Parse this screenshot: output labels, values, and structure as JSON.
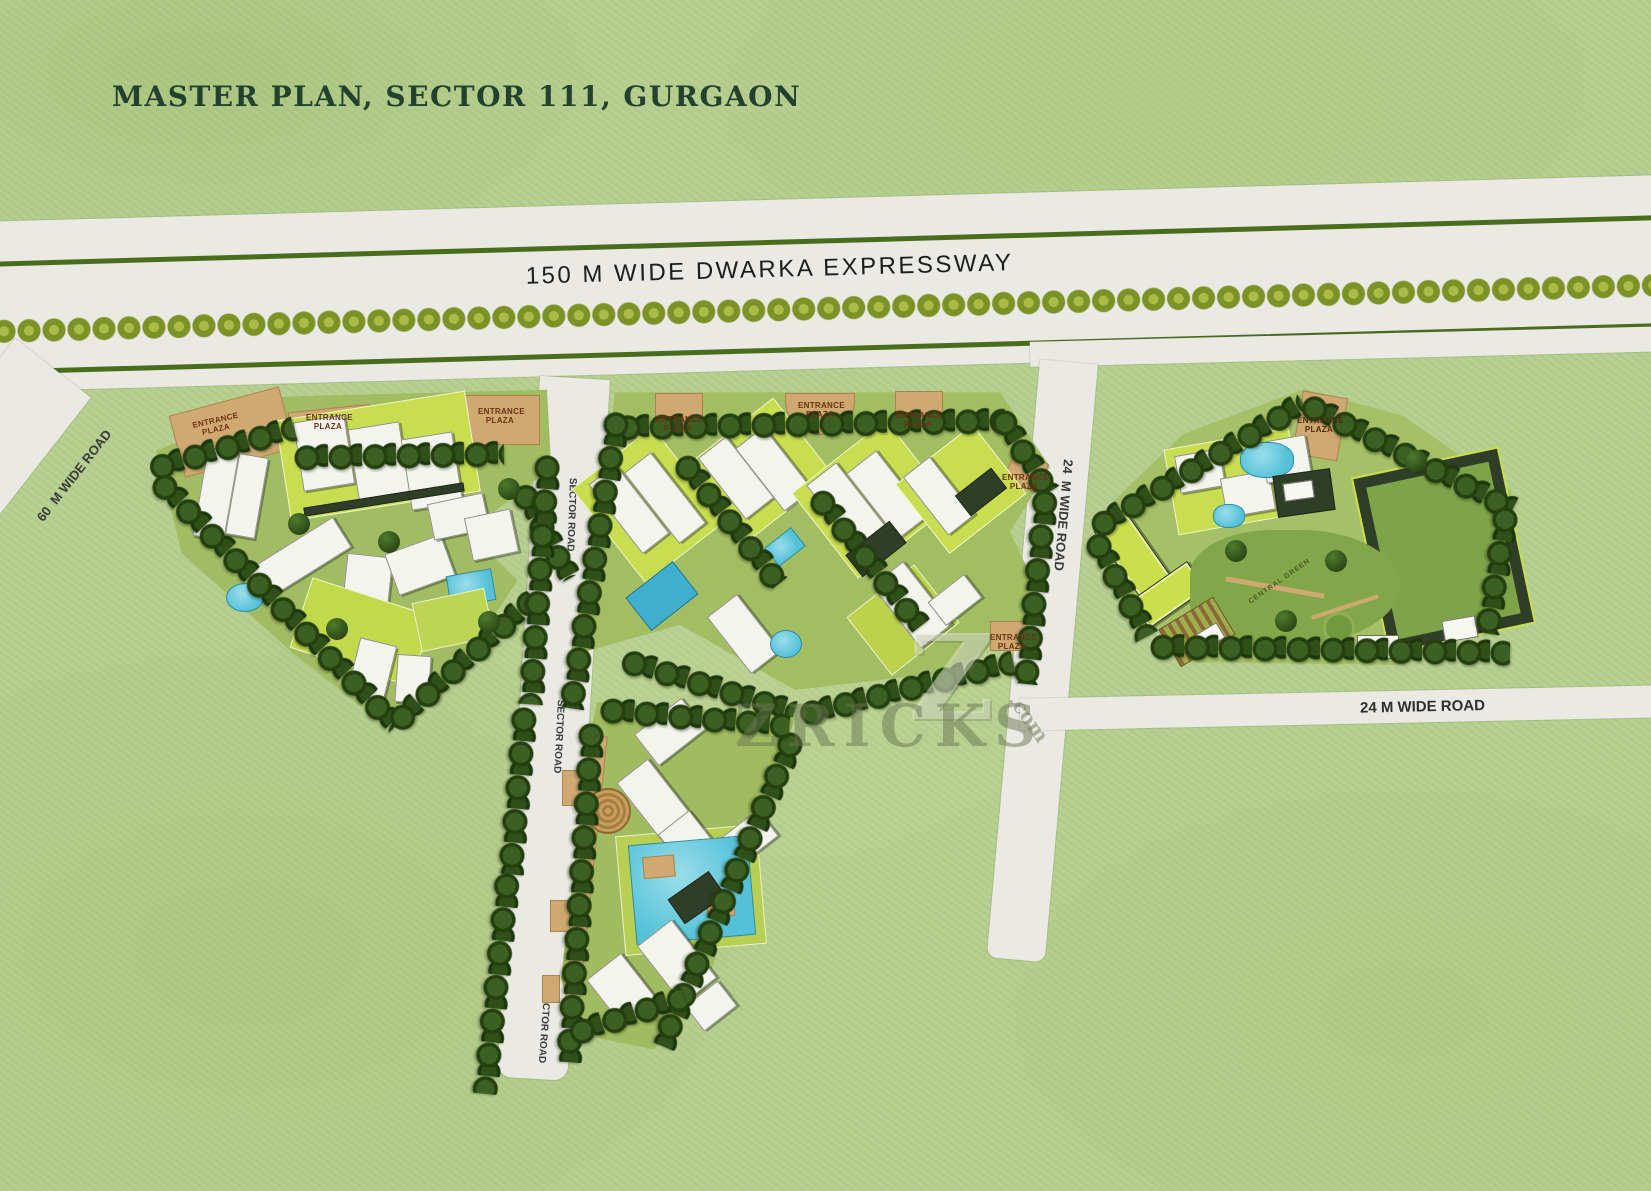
{
  "title": "MASTER PLAN, SECTOR 111, GURGAON",
  "roads": {
    "expressway_label": "150 M WIDE DWARKA EXPRESSWAY",
    "road_60m_label": "60  M WIDE ROAD",
    "sector_road_label": "SECTOR ROAD",
    "road_24m_vertical_label": "24  M WIDE ROAD",
    "road_24m_horizontal_label": "24 M WIDE ROAD"
  },
  "site_labels": {
    "entrance_plaza": "ENTRANCE PLAZA",
    "central_green": "CENTRAL GREEN"
  },
  "watermark": {
    "initial": "Z",
    "name": "ZRICKS",
    "suffix": ".com"
  },
  "colors": {
    "grass": "#b6cf8f",
    "road_gray": "#eae9e4",
    "tree_dark": "#2a4716",
    "hedge_green": "#4a6d1d",
    "median_tree_olive": "#7d9226",
    "lawn_bright": "#cbdf4d",
    "pool_blue": "#54c1d8",
    "plaza_tan": "#cfa971",
    "title_green": "#24402f",
    "label_brown": "#6b3113"
  }
}
